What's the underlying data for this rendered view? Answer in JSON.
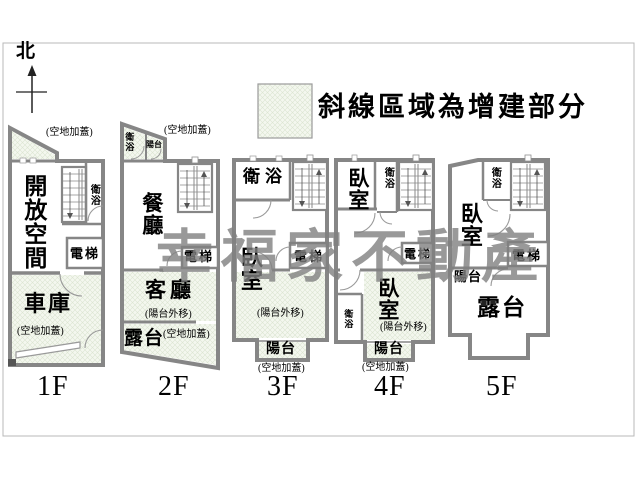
{
  "canvas": {
    "border_color": "#b8b8b8",
    "wall_color": "#868686",
    "hatch_fill": "#f4f7ef",
    "hatch_line_color": "#dbe5d1",
    "watermark_color": "#828282"
  },
  "compass": {
    "north": "北"
  },
  "legend": {
    "note": "斜線區域為增建部分"
  },
  "watermark": {
    "text": "幸福家不動產"
  },
  "floors": [
    {
      "label": "1F",
      "top_note": "(空地加蓋)",
      "open_space": "開放空間",
      "bath": "衛浴",
      "elevator": "電梯",
      "garage": "車庫",
      "garage_note": "(空地加蓋)"
    },
    {
      "label": "2F",
      "bath": "衛浴",
      "balcony": "陽台",
      "top_note": "(空地加蓋)",
      "dining": "餐廳",
      "elevator": "電梯",
      "living": "客廳",
      "living_note": "(陽台外移)",
      "terrace": "露台",
      "terrace_note": "(空地加蓋)"
    },
    {
      "label": "3F",
      "bath": "衛浴",
      "bedroom": "臥室",
      "elevator": "電梯",
      "shift_note": "(陽台外移)",
      "balcony": "陽台",
      "balcony_note": "(空地加蓋)"
    },
    {
      "label": "4F",
      "bedroom_top": "臥室",
      "bath_top": "衛浴",
      "elevator": "電梯",
      "bedroom_main": "臥室",
      "shift_note": "(陽台外移)",
      "bath_small": "衛浴",
      "balcony": "陽台",
      "balcony_note": "(空地加蓋)"
    },
    {
      "label": "5F",
      "bedroom": "臥室",
      "bath": "衛浴",
      "elevator": "電梯",
      "balcony": "陽台",
      "terrace": "露台"
    }
  ]
}
